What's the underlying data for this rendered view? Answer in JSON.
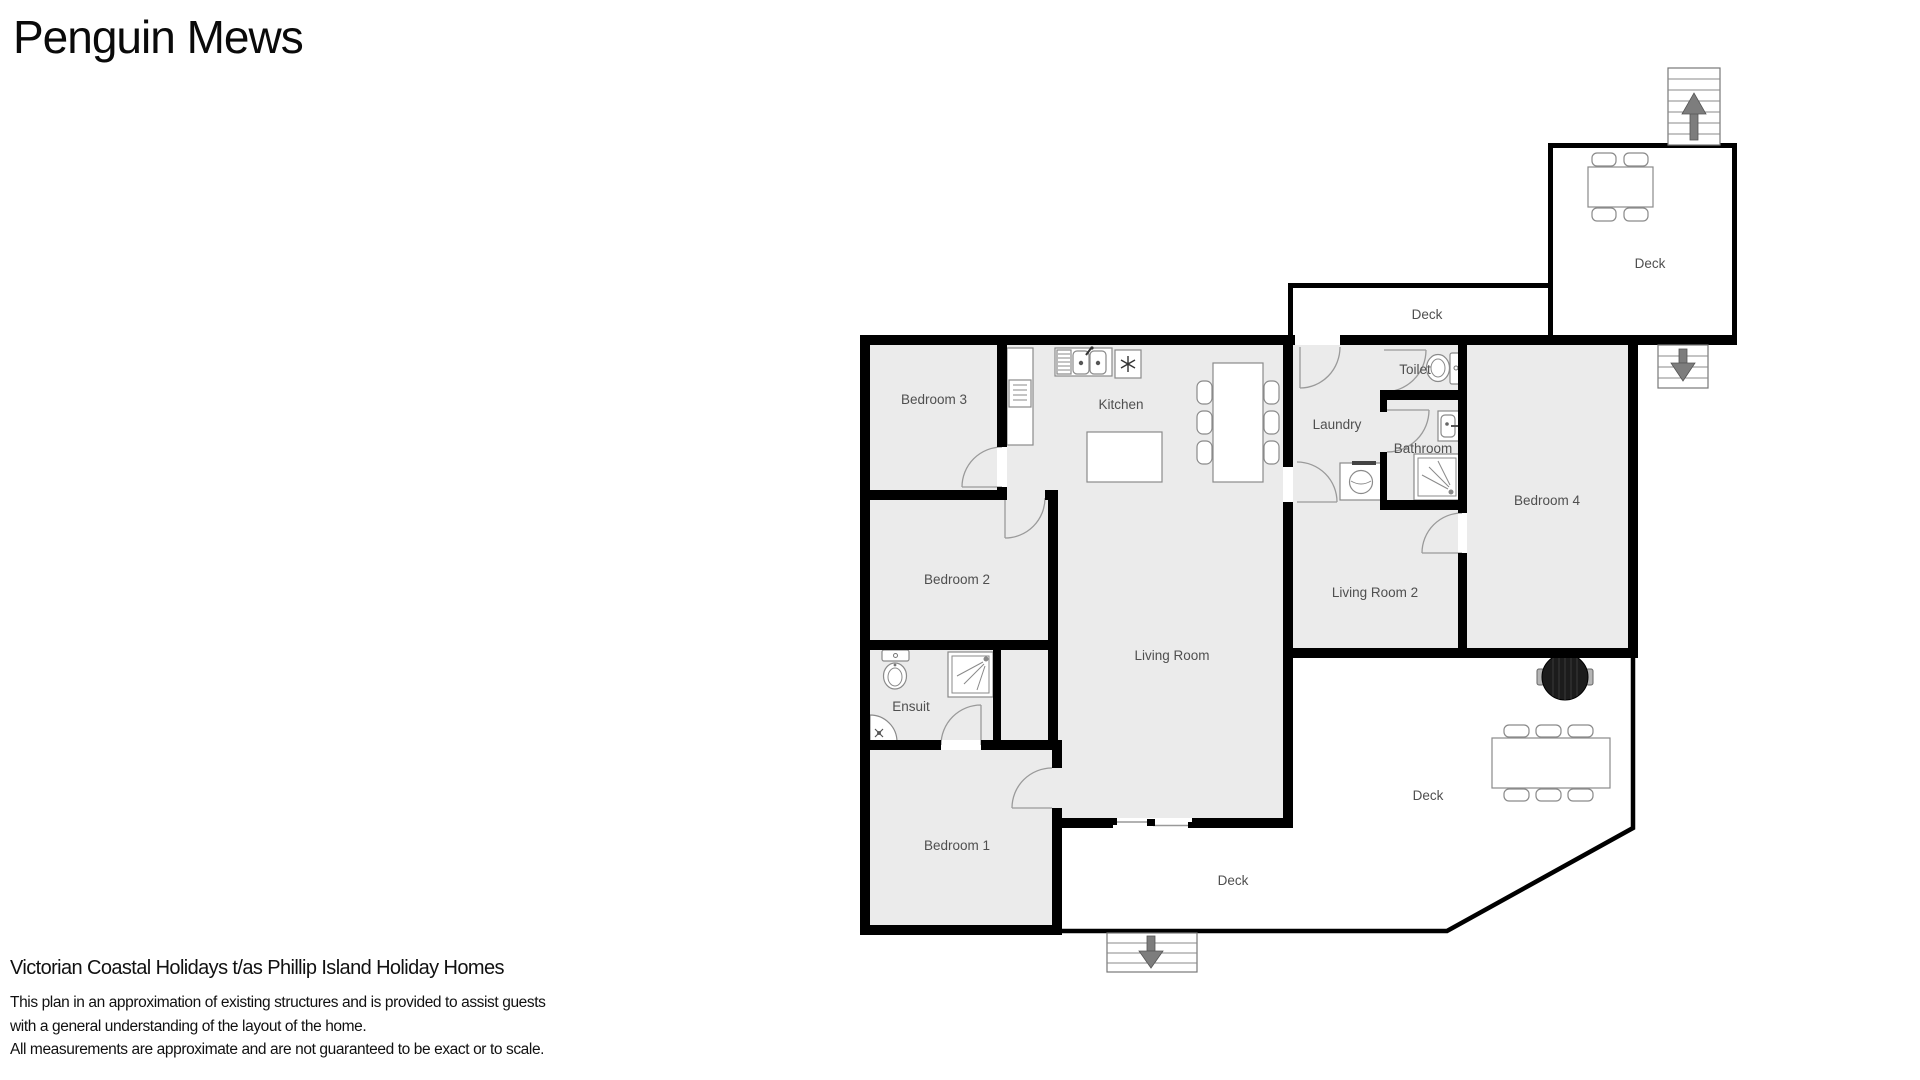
{
  "title": "Penguin Mews",
  "plan": {
    "rooms": {
      "bedroom1": "Bedroom 1",
      "bedroom2": "Bedroom 2",
      "bedroom3": "Bedroom 3",
      "bedroom4": "Bedroom 4",
      "kitchen": "Kitchen",
      "living_room": "Living Room",
      "living_room2": "Living Room 2",
      "laundry": "Laundry",
      "toilet": "Toilet",
      "bathroom": "Bathroom",
      "ensuite": "Ensuit",
      "deck": "Deck"
    },
    "colors": {
      "wall": "#000000",
      "room_fill": "#ebebeb",
      "deck_fill": "#ffffff",
      "label": "#4f4f4f",
      "fixture": "#8a8a8a",
      "arrow": "#7d7d7d",
      "bbq": "#1c1c1c"
    }
  },
  "footer": {
    "company": "Victorian Coastal Holidays t/as Phillip Island Holiday Homes",
    "disclaimer_line1": "This plan in an approximation of existing structures and is provided to assist guests",
    "disclaimer_line2": "with a general understanding of the layout of the home.",
    "disclaimer_line3": "All measurements are approximate and are not guaranteed to be exact or to scale."
  }
}
